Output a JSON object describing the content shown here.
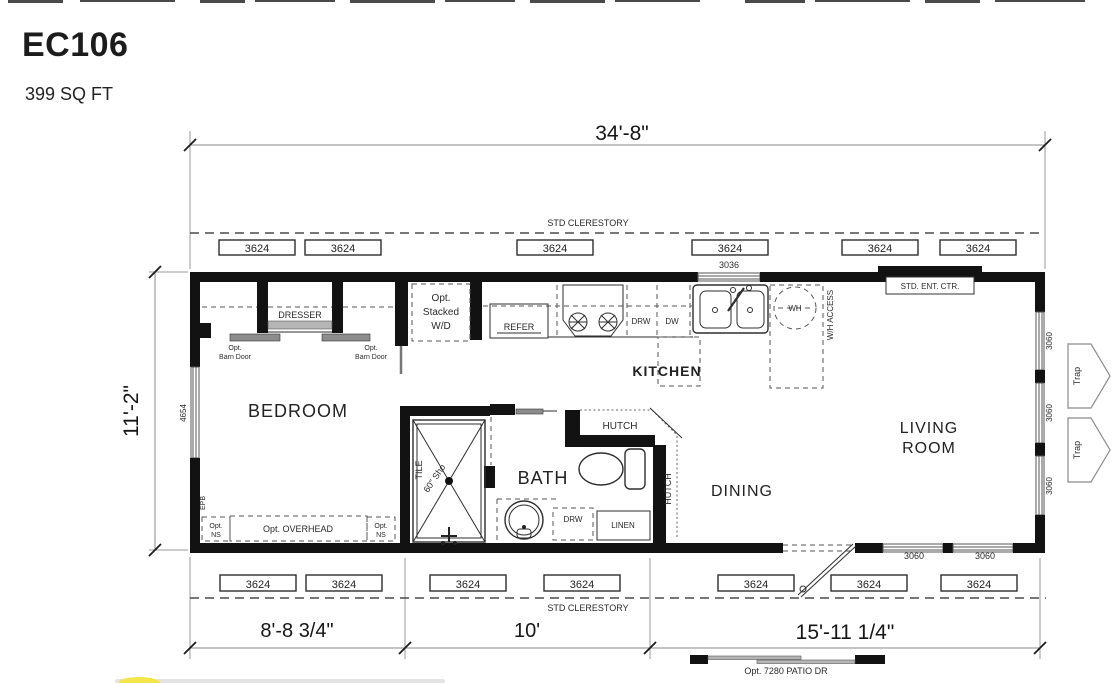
{
  "page": {
    "title": "EC106",
    "subtitle": "399 SQ FT"
  },
  "dims": {
    "width": "34'-8\"",
    "depth": "11'-2\"",
    "seg1": "8'-8 3/4\"",
    "seg2": "10'",
    "seg3": "15'-11 1/4\""
  },
  "clerestory": {
    "top": "STD CLERESTORY",
    "bottom": "STD CLERESTORY"
  },
  "windows": {
    "w3624": "3624",
    "w3036": "3036",
    "w3060": "3060",
    "w4654": "4654"
  },
  "rooms": {
    "bedroom": "BEDROOM",
    "kitchen": "KITCHEN",
    "bath": "BATH",
    "dining": "DINING",
    "living1": "LIVING",
    "living2": "ROOM"
  },
  "fixtures": {
    "dresser": "DRESSER",
    "opt": "Opt.",
    "barn_door": "Barn Door",
    "stacked": "Stacked",
    "wd": "W/D",
    "refer": "REFER",
    "drw": "DRW",
    "dw": "DW",
    "wh": "WH",
    "wh_access": "W/H ACCESS",
    "ent_ctr": "STD. ENT. CTR.",
    "hutch": "HUTCH",
    "tile": "TILE",
    "shower": "60\" Sho",
    "linen": "LINEN",
    "epb": "EPB",
    "ns": "NS",
    "overhead": "Opt. OVERHEAD",
    "trap": "Trap",
    "patio": "Opt. 7280 PATIO DR"
  }
}
